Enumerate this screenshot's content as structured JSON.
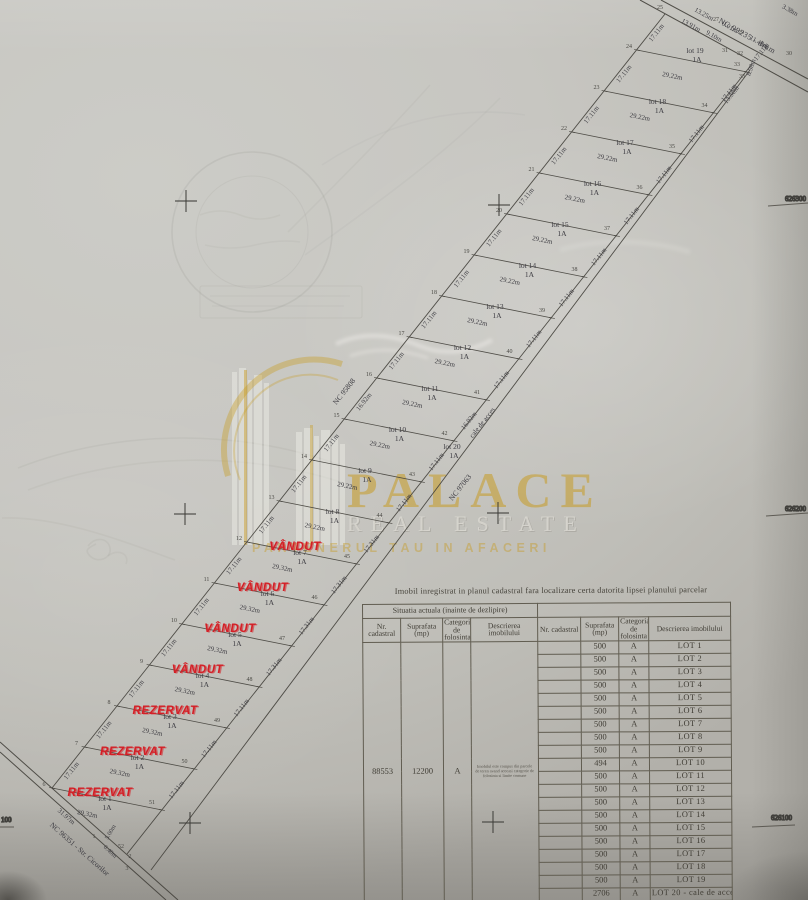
{
  "photo": {
    "width": 808,
    "height": 900
  },
  "watermark": {
    "brand": "PALACE",
    "line2": "REAL ESTATE",
    "slogan": "PARTENERUL TAU IN AFACERI",
    "gold": "#c79a1e"
  },
  "plan": {
    "class_label": "1A",
    "roads": {
      "top": "NC 99235 - drum",
      "bottom": "NC 96351 - Str. Cicorilor",
      "bottom_length": "31.97m",
      "neighbor_nw": "NC 95808",
      "neighbor_se": "NC 97063"
    },
    "access": {
      "lot": "lot 20",
      "cls": "1A",
      "name": "cale de acces"
    },
    "status_colors": {
      "sold": "#d41f26",
      "reserved": "#d41f26"
    },
    "lots": [
      {
        "n": 1,
        "status": "REZERVAT",
        "left": "17.11m",
        "bottom": "29.32m",
        "right": "17.11m"
      },
      {
        "n": 2,
        "status": "REZERVAT",
        "left": "17.11m",
        "bottom": "29.32m",
        "right": "17.11m"
      },
      {
        "n": 3,
        "status": "REZERVAT",
        "left": "17.11m",
        "bottom": "29.32m",
        "right": "17.11m"
      },
      {
        "n": 4,
        "status": "VÂNDUT",
        "left": "17.11m",
        "bottom": "29.32m",
        "right": "17.31m"
      },
      {
        "n": 5,
        "status": "VÂNDUT",
        "left": "17.11m",
        "bottom": "29.32m",
        "right": "17.31m"
      },
      {
        "n": 6,
        "status": "VÂNDUT",
        "left": "17.11m",
        "bottom": "29.32m",
        "right": "17.31m"
      },
      {
        "n": 7,
        "status": "VÂNDUT",
        "left": "17.11m",
        "bottom": "29.32m",
        "right": "17.31m"
      },
      {
        "n": 8,
        "status": "",
        "left": "17.11m",
        "bottom": "29.22m",
        "right": "17.11m"
      },
      {
        "n": 9,
        "status": "",
        "left": "17.11m",
        "bottom": "29.22m",
        "right": "17.11m"
      },
      {
        "n": 10,
        "status": "",
        "left": "16.92m",
        "bottom": "29.22m",
        "right": "16.92m"
      },
      {
        "n": 11,
        "status": "",
        "left": "17.11m",
        "bottom": "29.22m",
        "right": "17.11m"
      },
      {
        "n": 12,
        "status": "",
        "left": "17.11m",
        "bottom": "29.22m",
        "right": "17.11m"
      },
      {
        "n": 13,
        "status": "",
        "left": "17.11m",
        "bottom": "29.22m",
        "right": "17.11m"
      },
      {
        "n": 14,
        "status": "",
        "left": "17.11m",
        "bottom": "29.22m",
        "right": "17.11m"
      },
      {
        "n": 15,
        "status": "",
        "left": "17.11m",
        "bottom": "29.22m",
        "right": "17.11m"
      },
      {
        "n": 16,
        "status": "",
        "left": "17.11m",
        "bottom": "29.22m",
        "right": "17.11m"
      },
      {
        "n": 17,
        "status": "",
        "left": "17.11m",
        "bottom": "29.22m",
        "right": "17.11m"
      },
      {
        "n": 18,
        "status": "",
        "left": "17.11m",
        "bottom": "29.22m",
        "right": "17.11m"
      },
      {
        "n": 19,
        "status": "",
        "left": "17.11m",
        "bottom": "29.22m",
        "right": "17.11m"
      }
    ],
    "top_dims": [
      {
        "t": "13.25m",
        "x": 703,
        "y": 16,
        "r": 29
      },
      {
        "t": "13.91m",
        "x": 690,
        "y": 27,
        "r": 29
      },
      {
        "t": "9.01m",
        "x": 729,
        "y": 29,
        "r": 29
      },
      {
        "t": "9.10m",
        "x": 713,
        "y": 38,
        "r": 29
      },
      {
        "t": "11.48m",
        "x": 758,
        "y": 44,
        "r": 29
      },
      {
        "t": "8.98m",
        "x": 753,
        "y": 68,
        "r": -72
      },
      {
        "t": "3.38m",
        "x": 789,
        "y": 12,
        "r": 29
      },
      {
        "t": "13.50m",
        "x": 733,
        "y": 96,
        "r": -52
      }
    ],
    "tip_dims": [
      {
        "t": "5.00m",
        "x": 112,
        "y": 833,
        "r": -60
      },
      {
        "t": "6.40m",
        "x": 109,
        "y": 853,
        "r": 42
      }
    ],
    "vertices": {
      "left": [
        "6",
        "7",
        "8",
        "9",
        "10",
        "11",
        "12",
        "13",
        "14",
        "15",
        "16",
        "17",
        "18",
        "19",
        "20",
        "21",
        "22",
        "23",
        "24"
      ],
      "apex": "25",
      "right": [
        "51",
        "50",
        "49",
        "48",
        "47",
        "46",
        "45",
        "44",
        "43",
        "42",
        "41",
        "40",
        "39",
        "38",
        "37",
        "36",
        "35",
        "34",
        "33"
      ],
      "right_extra": [
        {
          "t": "31",
          "x": 725,
          "y": 52
        },
        {
          "t": "32",
          "x": 740,
          "y": 55
        },
        {
          "t": "33",
          "x": 742,
          "y": 78
        }
      ],
      "top": [
        {
          "t": "27",
          "x": 716,
          "y": 21
        },
        {
          "t": "29",
          "x": 741,
          "y": 34
        },
        {
          "t": "30",
          "x": 789,
          "y": 55
        }
      ],
      "bottom": [
        {
          "t": "52",
          "x": 121,
          "y": 848
        },
        {
          "t": "1",
          "x": 94,
          "y": 838
        },
        {
          "t": "2",
          "x": 130,
          "y": 858
        },
        {
          "t": "3",
          "x": 127,
          "y": 870
        }
      ]
    },
    "grid": {
      "right": [
        "626300",
        "626200",
        "626100"
      ],
      "left_partial": "100"
    }
  },
  "table": {
    "note": "Imobil inregistrat in planul cadastral fara localizare certa datorita lipsei planului parcelar",
    "group_header": "Situatia actuala (inainte de dezlipire)",
    "columns": [
      "Nr. cadastral",
      "Suprafata (mp)",
      "Categoria de folosinta",
      "Descrierea imobilului"
    ],
    "before": {
      "nr": "88553",
      "area": "12200",
      "cat": "A",
      "desc": "Imobilul este compus din parcele de teren avand aceeasi categorie de folosinta si limite comune"
    },
    "rows": [
      {
        "area": "500",
        "cat": "A",
        "desc": "LOT 1"
      },
      {
        "area": "500",
        "cat": "A",
        "desc": "LOT 2"
      },
      {
        "area": "500",
        "cat": "A",
        "desc": "LOT 3"
      },
      {
        "area": "500",
        "cat": "A",
        "desc": "LOT 4"
      },
      {
        "area": "500",
        "cat": "A",
        "desc": "LOT 5"
      },
      {
        "area": "500",
        "cat": "A",
        "desc": "LOT 6"
      },
      {
        "area": "500",
        "cat": "A",
        "desc": "LOT 7"
      },
      {
        "area": "500",
        "cat": "A",
        "desc": "LOT 8"
      },
      {
        "area": "500",
        "cat": "A",
        "desc": "LOT 9"
      },
      {
        "area": "494",
        "cat": "A",
        "desc": "LOT 10"
      },
      {
        "area": "500",
        "cat": "A",
        "desc": "LOT 11"
      },
      {
        "area": "500",
        "cat": "A",
        "desc": "LOT 12"
      },
      {
        "area": "500",
        "cat": "A",
        "desc": "LOT 13"
      },
      {
        "area": "500",
        "cat": "A",
        "desc": "LOT 14"
      },
      {
        "area": "500",
        "cat": "A",
        "desc": "LOT 15"
      },
      {
        "area": "500",
        "cat": "A",
        "desc": "LOT 16"
      },
      {
        "area": "500",
        "cat": "A",
        "desc": "LOT 17"
      },
      {
        "area": "500",
        "cat": "A",
        "desc": "LOT 18"
      },
      {
        "area": "500",
        "cat": "A",
        "desc": "LOT 19"
      },
      {
        "area": "2706",
        "cat": "A",
        "desc": "LOT 20 - cale de acces"
      }
    ],
    "total": {
      "label": "Total",
      "area": "12200",
      "dash": "-"
    }
  }
}
